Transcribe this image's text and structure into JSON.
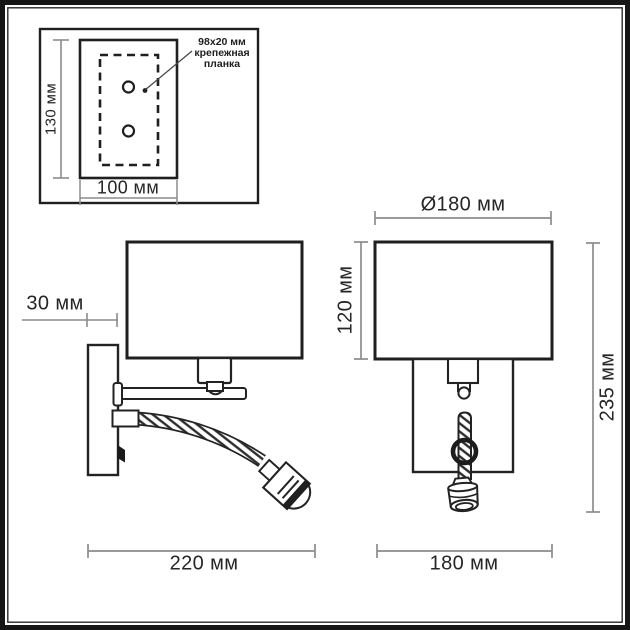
{
  "colors": {
    "outline": "#232323",
    "dimension_line": "#8c8c8c",
    "text": "#262626",
    "background": "#ffffff",
    "frame": "#161616"
  },
  "mounting_plate_inset": {
    "height_label": "130 мм",
    "width_label": "100 мм",
    "callout": {
      "line1": "98x20 мм",
      "line2": "крепежная",
      "line3": "планка"
    }
  },
  "side_view": {
    "wall_offset_label": "30 мм",
    "overall_depth_label": "220 мм"
  },
  "front_view": {
    "shade_diameter_label": "Ø180 мм",
    "shade_height_label": "120 мм",
    "overall_height_label": "235 мм",
    "base_width_label": "180 мм"
  }
}
